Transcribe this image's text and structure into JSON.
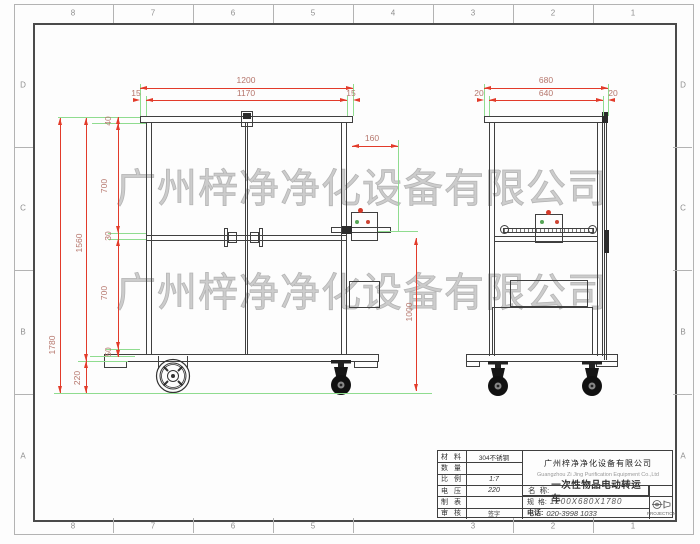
{
  "sheet": {
    "grid_cols": [
      "8",
      "7",
      "6",
      "5",
      "4",
      "3",
      "2",
      "1"
    ],
    "grid_rows": [
      "D",
      "C",
      "B",
      "A"
    ]
  },
  "watermark": {
    "text": "广州梓净净化设备有限公司"
  },
  "views": {
    "front": {
      "dims": {
        "width": "1200",
        "width_inner": "1170",
        "margin_left": "15",
        "margin_right": "15",
        "height_total": "1780",
        "height_frame": "1560",
        "bottom_clearance": "220",
        "seg_top": "40",
        "seg_upper": "700",
        "seg_mid": "30",
        "seg_lower": "700",
        "seg_bottom": "50",
        "box_offset": "160",
        "control_height": "1000"
      }
    },
    "side": {
      "dims": {
        "depth": "680",
        "depth_inner": "640",
        "margin_left": "20",
        "margin_right": "20"
      }
    }
  },
  "title_block": {
    "rows": [
      {
        "label": "材 料",
        "value": "304不锈钢"
      },
      {
        "label": "数 量",
        "value": ""
      },
      {
        "label": "比 例",
        "value": "1:7"
      },
      {
        "label": "电 压",
        "value": "220"
      },
      {
        "label": "制 表",
        "value": ""
      },
      {
        "label": "审 核",
        "value": "签字"
      }
    ],
    "company_cn": "广州梓净净化设备有限公司",
    "company_en": "Guangzhou Zi Jing Purification Equipment Co.,Ltd",
    "name_label": "名  称:",
    "name_value": "一次性物品电动转运车",
    "spec_label": "规  格:",
    "spec_value": "1200X680X1780",
    "tel_label": "电话:",
    "tel_value": "020-3998 1033",
    "projection": "PROJECTION"
  }
}
